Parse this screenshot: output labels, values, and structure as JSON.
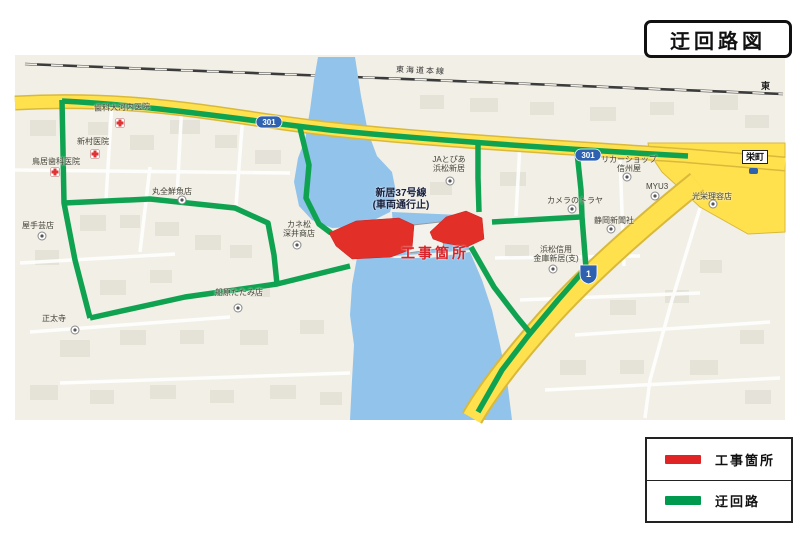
{
  "title": "迂回路図",
  "legend": {
    "items": [
      {
        "label": "工事箇所",
        "color": "#e02325"
      },
      {
        "label": "迂回路",
        "color": "#009a4e"
      }
    ]
  },
  "map": {
    "railway_label": "東海道本線",
    "east_label": "東",
    "junction_label": "栄町",
    "closure": {
      "line1": "新居37号線",
      "line2": "(車両通行止)"
    },
    "construction_label": "工事箇所",
    "shields": [
      "301",
      "301",
      "1"
    ],
    "colors": {
      "detour_green": "#0fa351",
      "construction_red": "#e02325",
      "main_road_yellow": "#ffe14e",
      "water_blue": "#92c3eb",
      "map_background": "#f2efe6"
    },
    "places": [
      {
        "name": "歯科大河内医院"
      },
      {
        "name": "新村医院"
      },
      {
        "name": "鳥居歯科医院"
      },
      {
        "name": "丸全鮮魚店"
      },
      {
        "name": "カネ松\n深井商店"
      },
      {
        "name": "船原たたみ店"
      },
      {
        "name": "正太寺"
      },
      {
        "name": "屋手芸店"
      },
      {
        "name": "JAとぴあ\n浜松新居"
      },
      {
        "name": "カメラのトラヤ"
      },
      {
        "name": "静岡新聞社"
      },
      {
        "name": "浜松信用\n金庫新居(支)"
      },
      {
        "name": "リカーショップ\n信州屋"
      },
      {
        "name": "MYU3"
      },
      {
        "name": "光栄理容店"
      }
    ]
  }
}
